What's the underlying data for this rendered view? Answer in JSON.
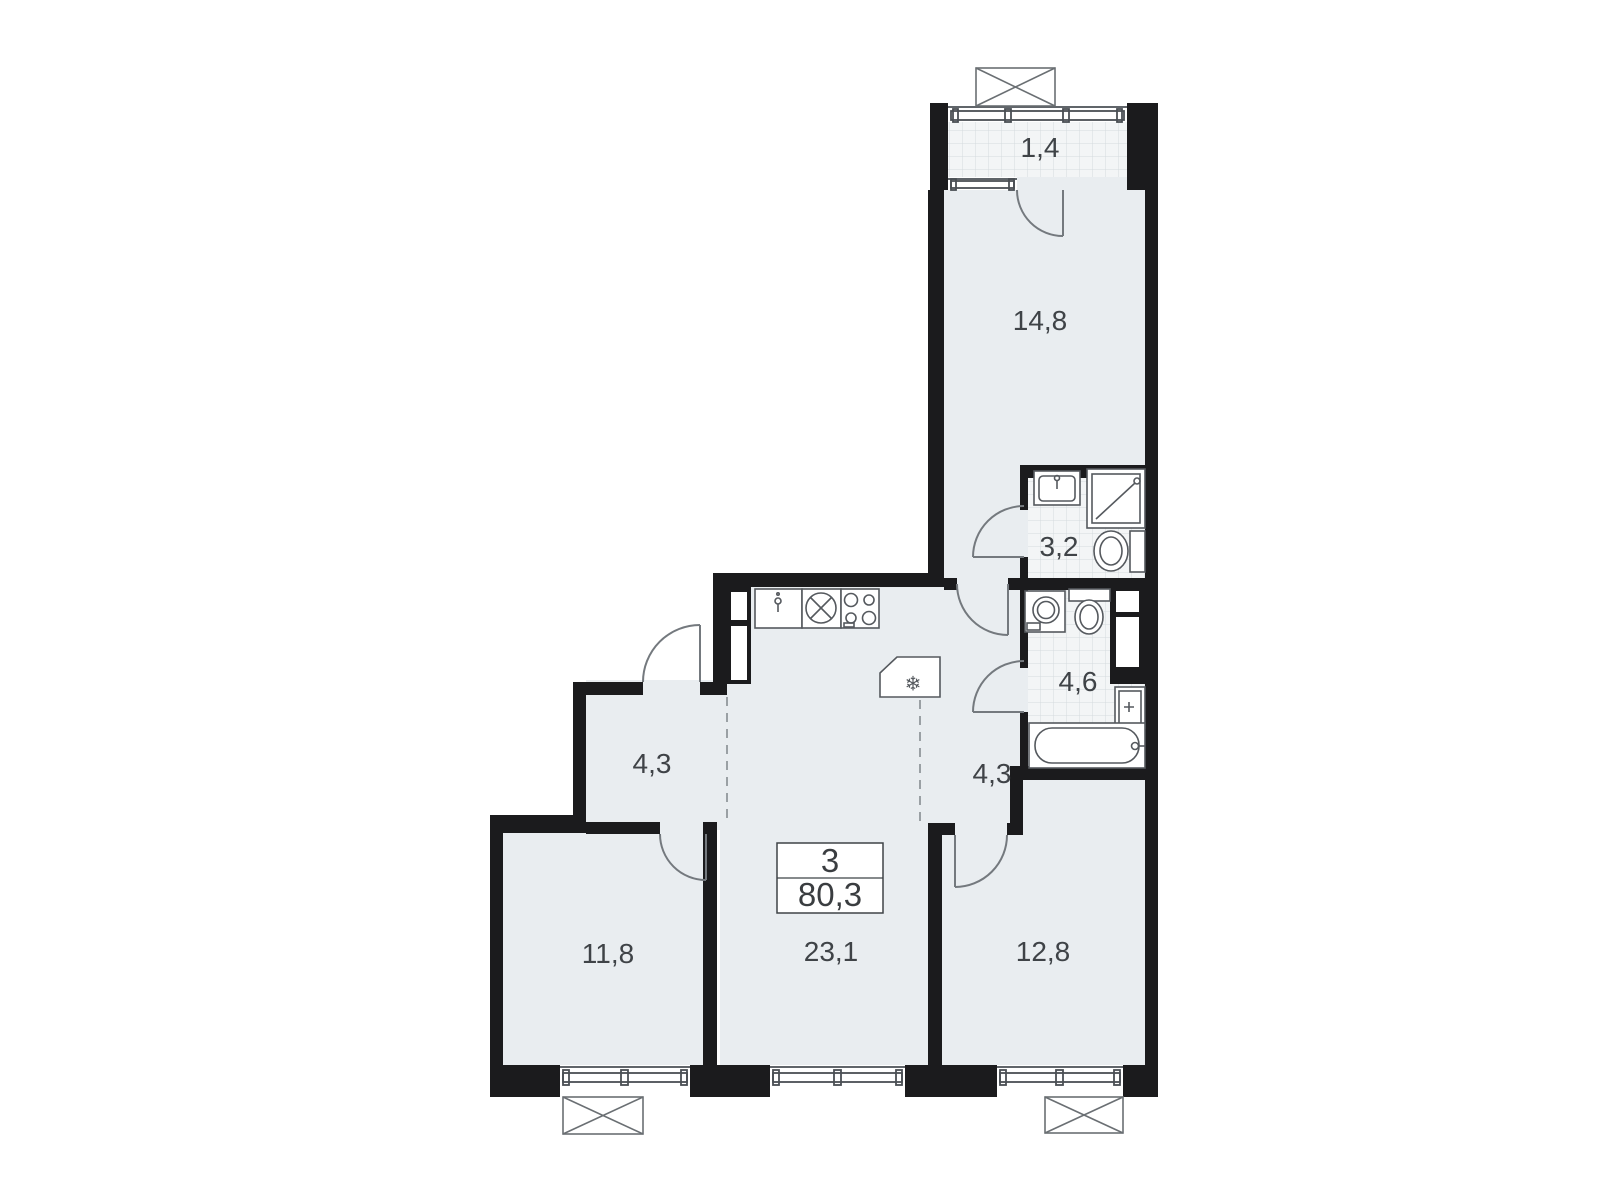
{
  "floor_plan": {
    "summary": {
      "rooms_count": "3",
      "total_area": "80,3"
    },
    "rooms": [
      {
        "name": "balcony",
        "area": "1,4"
      },
      {
        "name": "bedroom-top",
        "area": "14,8"
      },
      {
        "name": "bathroom-shower",
        "area": "3,2"
      },
      {
        "name": "bathroom-main",
        "area": "4,6"
      },
      {
        "name": "hallway-right",
        "area": "4,3"
      },
      {
        "name": "hallway-entrance",
        "area": "4,3"
      },
      {
        "name": "bedroom-left",
        "area": "11,8"
      },
      {
        "name": "kitchen-living",
        "area": "23,1"
      },
      {
        "name": "bedroom-right",
        "area": "12,8"
      }
    ],
    "colors": {
      "wall": "#1b1b1d",
      "floor": "#e9edf0",
      "tile_background": "#f3f5f6",
      "tile_line": "#d4dade",
      "fixture_line": "#55595e",
      "label_text": "#3f4347"
    }
  }
}
